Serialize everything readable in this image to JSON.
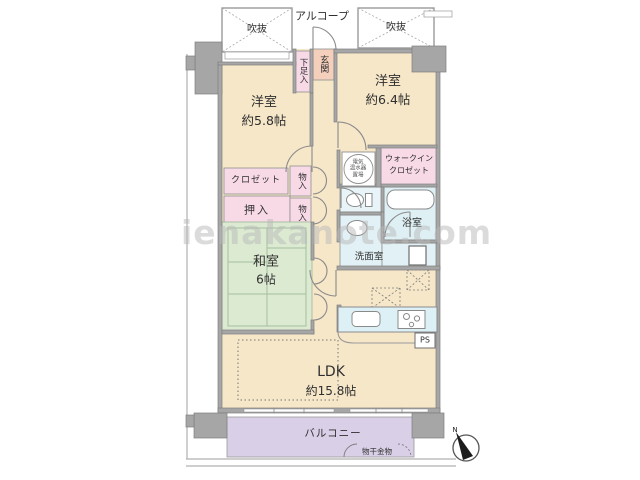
{
  "watermark": "ienakanote.com",
  "palette": {
    "room_cream": "#f6e7c9",
    "closet_pink": "#f8dae7",
    "entry_salmon": "#f3cfbc",
    "tatami_green": "#dceAD2",
    "wet_area_blue": "#e2f1f5",
    "balcony_purple": "#d9cfe7",
    "wall_gray": "#a6a6a6"
  },
  "labels": {
    "alcove": "アルコープ",
    "void_left": "吹抜",
    "void_right": "吹抜",
    "entrance": "玄関",
    "shoe_cabinet": "下足入",
    "room58": {
      "name": "洋室",
      "size": "約5.8帖"
    },
    "room64": {
      "name": "洋室",
      "size": "約6.4帖"
    },
    "closet": "クロゼット",
    "storage_top": "物入",
    "storage_bottom": "物入",
    "oshiire": "押入",
    "japanese_room": {
      "name": "和室",
      "size": "6帖"
    },
    "walk_in_closet": {
      "line1": "ウォークイン",
      "line2": "クロゼット"
    },
    "water_heater": {
      "line1": "電気",
      "line2": "温水器",
      "line3": "置場"
    },
    "bathroom": "浴室",
    "washroom": "洗面室",
    "ldk": {
      "name": "LDK",
      "size": "約15.8帖"
    },
    "pipe_space": "PS",
    "balcony": "バルコニー",
    "laundry_hardware": "物干金物",
    "compass_north": "N"
  }
}
